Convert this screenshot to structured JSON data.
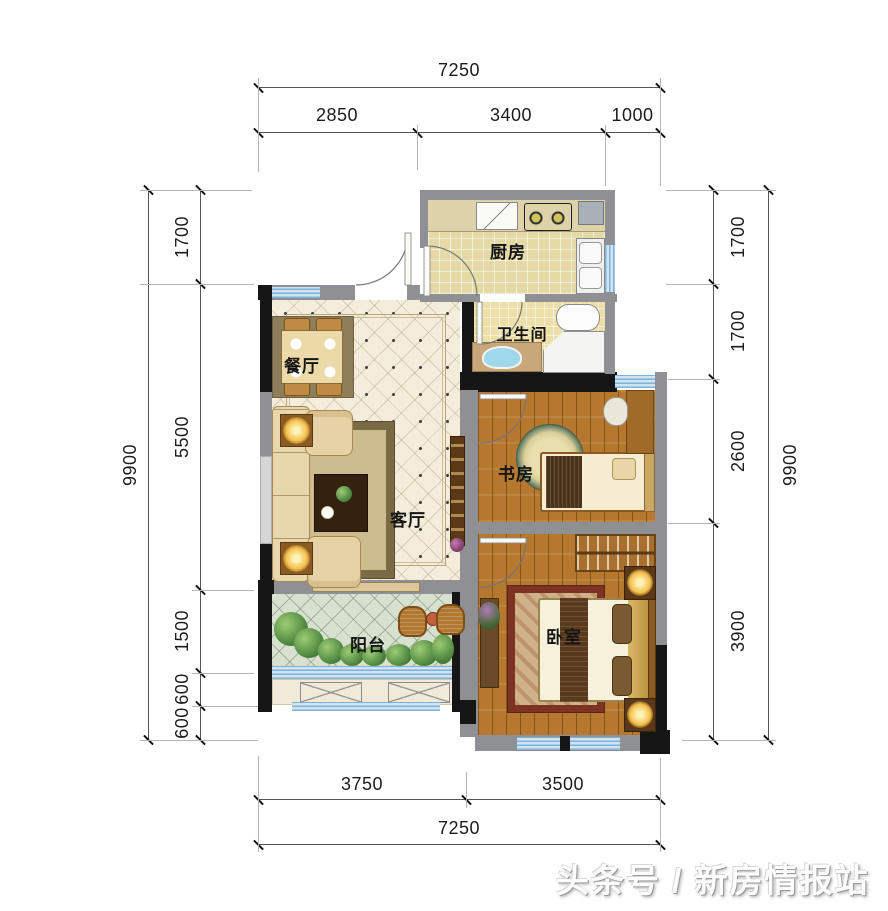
{
  "rooms": {
    "kitchen": {
      "label": "厨房"
    },
    "bathroom": {
      "label": "卫生间"
    },
    "dining": {
      "label": "餐厅"
    },
    "living": {
      "label": "客厅"
    },
    "study": {
      "label": "书房"
    },
    "bedroom": {
      "label": "卧室"
    },
    "balcony": {
      "label": "阳台"
    }
  },
  "dimensions": {
    "top": {
      "total": "7250",
      "segments": [
        "2850",
        "3400",
        "1000"
      ]
    },
    "bottom": {
      "total": "7250",
      "segments": [
        "3750",
        "3500"
      ]
    },
    "left": {
      "total": "9900",
      "segments": [
        "1700",
        "5500",
        "1500",
        "600",
        "600"
      ]
    },
    "right": {
      "total": "9900",
      "segments": [
        "1700",
        "1700",
        "2600",
        "3900"
      ]
    }
  },
  "watermark": {
    "text": "头条号 / 新房情报站"
  },
  "colors": {
    "wall_gray": "#8f9093",
    "wall_black": "#161616",
    "window_blue": "#cfe3f2",
    "wood_floor": "#b6772e",
    "tile_floor": "#e5d9a6",
    "balcony_floor": "#d8e1cf"
  }
}
